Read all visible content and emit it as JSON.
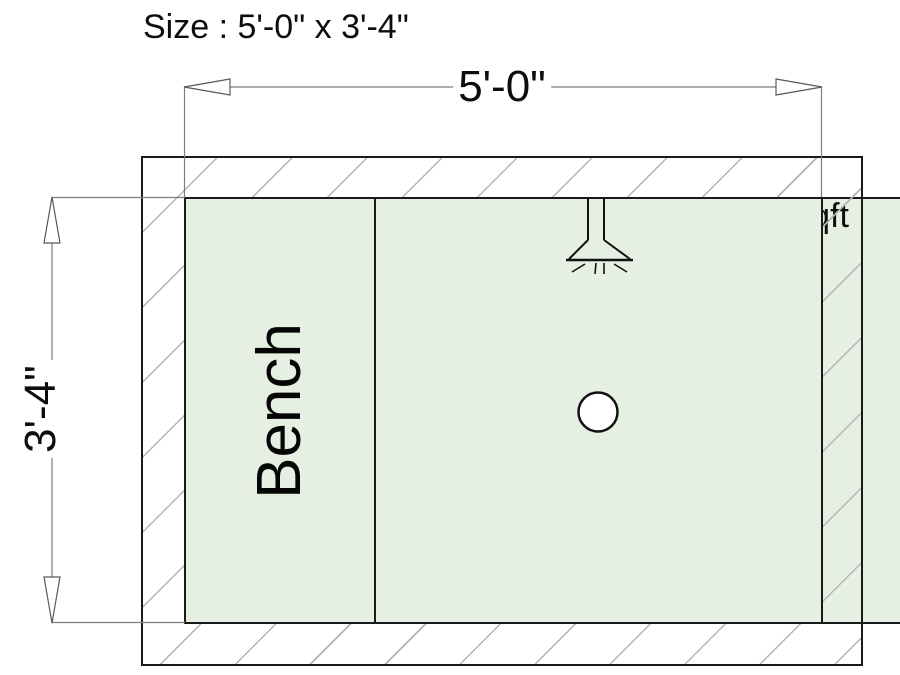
{
  "header": {
    "size_label": "Size : 5'-0\" x 3'-4\"",
    "heated_area_label": "Heated Area : 13sqft"
  },
  "dimensions": {
    "width": "5'-0\"",
    "height": "3'-4\""
  },
  "plan": {
    "bench_label": "Bench",
    "fixtures": [
      {
        "name": "shower-head",
        "icon": "shower-head-icon"
      },
      {
        "name": "drain",
        "icon": "drain-icon"
      }
    ],
    "colors": {
      "background": "#ffffff",
      "heated_area_fill": "#e6f0e2",
      "wall_hatch_line": "#b4b4b4",
      "outline": "#1a1a1a",
      "dimension_line": "#7d7d7d",
      "text": "#0d0d0d"
    }
  }
}
